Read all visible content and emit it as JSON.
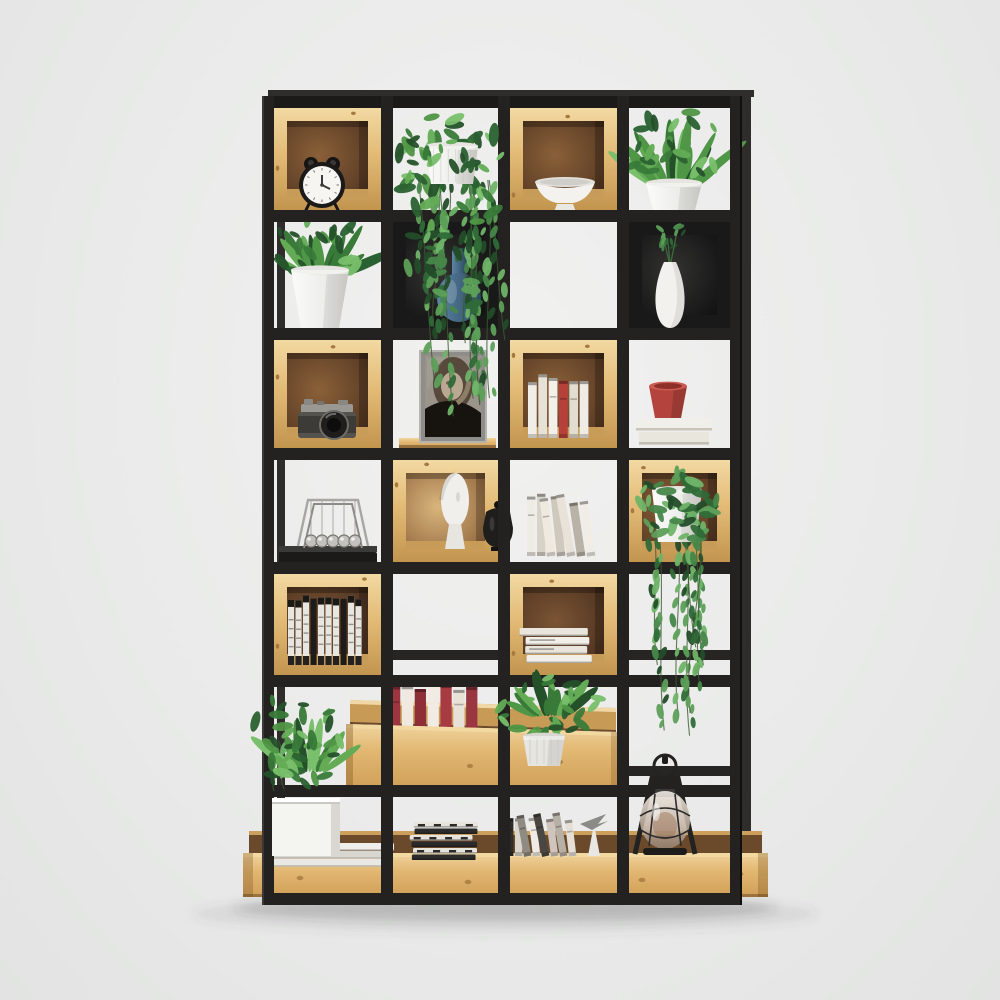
{
  "meta": {
    "description": "Studio product photo: industrial display bookshelf, black metal open grid frame of 4 columns by 7 rows with natural pine cube box inserts and a pine base tray, decorated with plants, books, alarm clock, camera, photo frame, vases, newton cradle, sculpture, magazines and an oil lantern on a seamless light grey backdrop.",
    "visible_text": "none"
  },
  "palette": {
    "bg": "#eaebea",
    "frame": "#232221",
    "frameDark": "#1b1a19",
    "rear": "#2e2d2c",
    "pineLight": "#f2d9a2",
    "pineFace": "#e3bb77",
    "pineDark": "#c2954f",
    "pineEdge": "#a6793f",
    "intDarkC": "#8a6038",
    "intDarkE": "#553823",
    "intLightC": "#d9b57c",
    "intLightE": "#93683f",
    "blackBox": "#191919",
    "blackBoxIn": "#343332",
    "white": "#f4f4f1",
    "whiteShade": "#d6d5d0",
    "greens": [
      "#2a6132",
      "#397a39",
      "#4f9646",
      "#63ac55",
      "#24512a",
      "#79bf6c"
    ],
    "vineGreens": [
      "#2f6a38",
      "#47874a",
      "#5d9f58",
      "#234c29",
      "#6fb468"
    ],
    "red": "#b3433c",
    "blueVase1": "#5d85a6",
    "blueVase2": "#2c4a60",
    "metal": "#a7a6a2",
    "shadow": "rgba(60,60,60,0.20)"
  },
  "grid": {
    "cols": [
      262,
      381,
      498,
      617,
      730
    ],
    "rows": [
      96,
      210,
      328,
      448,
      562,
      675,
      785,
      893
    ],
    "vbar": 12,
    "hbar": 12,
    "top": 96,
    "bottom": 905
  },
  "rear": {
    "top_rail": {
      "x": 268,
      "y": 90,
      "w": 486,
      "h": 7
    },
    "posts": [
      {
        "x": 742,
        "y": 91,
        "w": 9,
        "h": 742
      },
      {
        "x": 277,
        "y": 222,
        "w": 8,
        "h": 666
      }
    ],
    "braces": [
      {
        "x": 393,
        "y": 650,
        "w": 105,
        "h": 10
      },
      {
        "x": 629,
        "y": 650,
        "w": 112,
        "h": 10
      },
      {
        "x": 629,
        "y": 766,
        "w": 112,
        "h": 10
      }
    ]
  },
  "base_tray": {
    "x": 243,
    "w": 525,
    "back_y": 831,
    "back_h": 26,
    "face_y": 853,
    "face_h": 44
  },
  "floor_shadow": {
    "cx": 505,
    "cy": 908,
    "rx": 272,
    "ry": 13
  },
  "cubes": [
    {
      "row": 0,
      "col": 0,
      "kind": "d"
    },
    {
      "row": 0,
      "col": 2,
      "kind": "d"
    },
    {
      "row": 1,
      "col": 1,
      "kind": "k"
    },
    {
      "row": 1,
      "col": 3,
      "kind": "k"
    },
    {
      "row": 2,
      "col": 0,
      "kind": "d"
    },
    {
      "row": 2,
      "col": 2,
      "kind": "d"
    },
    {
      "row": 3,
      "col": 1,
      "kind": "l"
    },
    {
      "row": 3,
      "col": 3,
      "kind": "d"
    },
    {
      "row": 4,
      "col": 0,
      "kind": "m"
    },
    {
      "row": 4,
      "col": 2,
      "kind": "m"
    }
  ],
  "items_mid": [
    {
      "type": "plank",
      "name": "wood-plank",
      "p": {
        "x": 399,
        "y": 438,
        "w": 97,
        "h": 10
      }
    },
    {
      "type": "frame",
      "name": "photo-frame-portrait",
      "p": {
        "x": 419,
        "y": 350,
        "w": 68,
        "h": 93
      }
    },
    {
      "type": "clock",
      "name": "alarm-clock",
      "p": {
        "cx": 322,
        "cy": 185,
        "r": 23
      }
    },
    {
      "type": "bowl",
      "name": "pedestal-bowl",
      "p": {
        "cx": 565,
        "by": 212,
        "w": 60
      }
    },
    {
      "type": "plant",
      "name": "potted-plant-top-right",
      "p": {
        "px": 646,
        "py": 183,
        "pw": 56,
        "ph": 31,
        "taper": 8,
        "bx": 674,
        "by": 188,
        "spread": 46,
        "lh": 72,
        "nb": 16,
        "cx": 672,
        "cy": 146,
        "sx": 48,
        "sy": 38,
        "nl": 24,
        "seed": 11
      }
    },
    {
      "type": "plant",
      "name": "potted-plant-row2-left",
      "p": {
        "px": 291,
        "py": 270,
        "pw": 58,
        "ph": 58,
        "taper": 10,
        "bx": 320,
        "by": 276,
        "spread": 50,
        "lh": 58,
        "nb": 14,
        "cx": 318,
        "cy": 248,
        "sx": 52,
        "sy": 30,
        "nl": 22,
        "seed": 13
      }
    },
    {
      "type": "bluevase",
      "name": "blue-vase",
      "p": {
        "cx": 459,
        "y": 250,
        "h": 72
      }
    },
    {
      "type": "whitevase",
      "name": "white-vase-with-sprig",
      "p": {
        "cx": 670,
        "y": 262,
        "h": 66,
        "seed": 17
      }
    },
    {
      "type": "camera",
      "name": "vintage-camera",
      "p": {
        "x": 298,
        "y": 400,
        "w": 58
      }
    },
    {
      "type": "books",
      "name": "books-upright-row3",
      "p": {
        "x": 528,
        "y": 374,
        "w": 62,
        "h": 64,
        "lean": 0,
        "cols": [
          "#f1eee8",
          "#e7e2d7",
          "#f3f0e9",
          "#b6413b",
          "#e2ddd1",
          "#efece5"
        ]
      }
    },
    {
      "type": "cupbooks",
      "name": "red-cup-on-books",
      "p": {
        "x": 636,
        "y": 418,
        "w": 76,
        "cx": 668,
        "cy": 386
      }
    },
    {
      "type": "cradle",
      "name": "newtons-cradle",
      "p": {
        "x": 300,
        "y": 508
      }
    },
    {
      "type": "sculpt",
      "name": "head-sculpture-and-urn",
      "p": {
        "hx": 455,
        "ux": 498
      }
    },
    {
      "type": "books",
      "name": "books-leaning-row4",
      "p": {
        "x": 527,
        "y": 492,
        "w": 70,
        "h": 64,
        "lean": 1,
        "cols": [
          "#efece6",
          "#d8d3c9",
          "#efe9e0",
          "#cfc9bd",
          "#e8e2d8",
          "#b9b2a6",
          "#f1ede6"
        ]
      }
    },
    {
      "type": "booksbw",
      "name": "black-white-book-row",
      "p": {
        "x": 288,
        "y": 594,
        "w": 75,
        "h": 71
      }
    },
    {
      "type": "bookstack",
      "name": "book-stack",
      "p": {
        "x": 521,
        "y": 628,
        "w": 71,
        "n": 4,
        "bw": 0
      }
    },
    {
      "type": "slabs",
      "name": "white-book-slabs",
      "p": {
        "x": 266,
        "y": 843,
        "w": 128
      }
    },
    {
      "type": "crateback",
      "name": "wood-crate-back",
      "p": {}
    },
    {
      "type": "books",
      "name": "crate-books-red",
      "p": {
        "x": 389,
        "y": 680,
        "w": 90,
        "h": 56,
        "lean": 0,
        "cols": [
          "#9c3540",
          "#efe9e2",
          "#8e2f38",
          "#f1ebe3",
          "#a83a42",
          "#e8e1d8",
          "#993640"
        ]
      }
    },
    {
      "type": "cratefront",
      "name": "wood-crate-front",
      "p": {}
    },
    {
      "type": "bookstack",
      "name": "magazine-stack",
      "p": {
        "x": 409,
        "y": 822,
        "w": 68,
        "n": 6,
        "bw": 1
      }
    },
    {
      "type": "books",
      "name": "magazine-row",
      "p": {
        "x": 506,
        "y": 812,
        "w": 72,
        "h": 44,
        "lean": 1,
        "cols": [
          "#2c2c2c",
          "#d9d4cc",
          "#8f8a82",
          "#efebe4",
          "#4a4743",
          "#cfc5bd",
          "#b7b0a6",
          "#e5dfd6"
        ]
      }
    },
    {
      "type": "bird",
      "name": "paper-bird-ornament",
      "p": {
        "x": 580,
        "y": 812
      }
    }
  ],
  "items_front": [
    {
      "type": "hangplant",
      "name": "hanging-plant-cascade",
      "p": {
        "px": 426,
        "py": 146,
        "pw": 52,
        "ph": 38,
        "seed": 7,
        "top": 150,
        "bottom": 420,
        "spread": 85
      }
    },
    {
      "type": "vineplant",
      "name": "trailing-vine-plant",
      "p": {
        "px": 652,
        "py": 490,
        "pw": 50,
        "ph": 52,
        "seed": 23,
        "top": 520,
        "bottom": 742,
        "spread": 62
      }
    },
    {
      "type": "plantfg",
      "name": "crate-plant",
      "p": {
        "px": 523,
        "py": 736,
        "pw": 42,
        "ph": 30,
        "taper": 5,
        "bx": 550,
        "by": 716,
        "spread": 40,
        "lh": 46,
        "nb": 10,
        "cx": 552,
        "cy": 706,
        "sx": 55,
        "sy": 32,
        "nl": 30,
        "seed": 29
      }
    },
    {
      "type": "boxplanter",
      "name": "white-box-planter-plant",
      "p": {
        "bx": 272,
        "by": 798,
        "bw": 68,
        "bh": 58,
        "seed": 31
      }
    },
    {
      "type": "lantern",
      "name": "oil-lantern",
      "p": {
        "cx": 665,
        "y": 756
      }
    }
  ]
}
